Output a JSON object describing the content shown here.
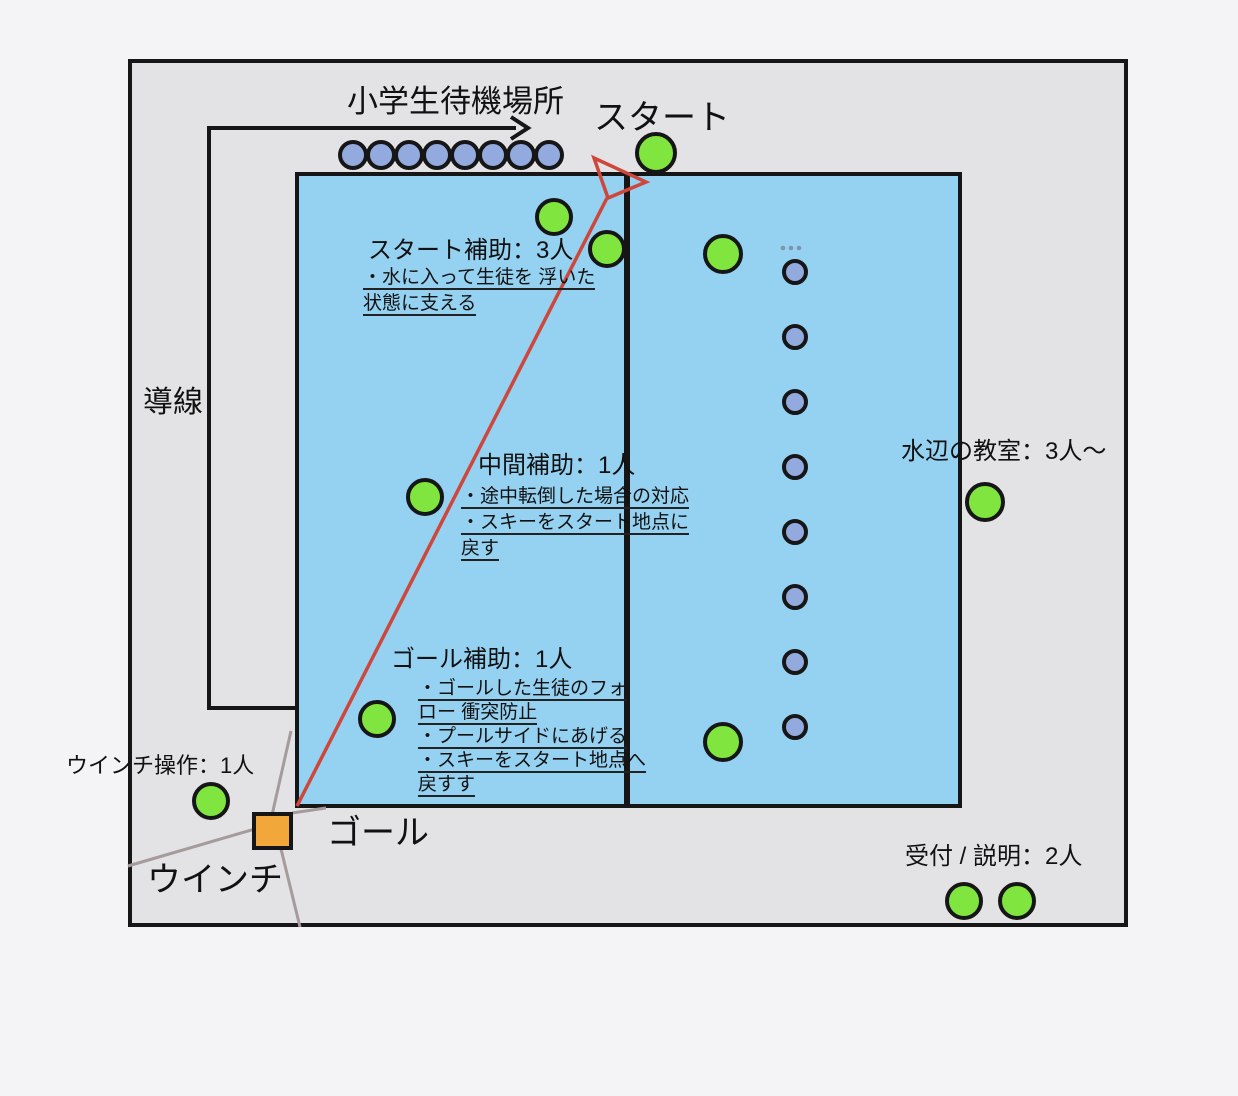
{
  "diagram": {
    "title_context": "プール水上スキー体験 配置図",
    "labels": {
      "waiting_area": "小学生待機場所",
      "start": "スタート",
      "guide_line": "導線",
      "goal": "ゴール",
      "winch": "ウインチ",
      "winch_operator": "ウインチ操作：1人",
      "classroom": "水辺の教室：3人〜",
      "reception": "受付 / 説明：2人"
    },
    "start_assist": {
      "title": "スタート補助：3人",
      "notes": [
        "・水に入って生徒を 浮いた",
        "状態に支える"
      ]
    },
    "middle_assist": {
      "title": "中間補助：1人",
      "notes": [
        "・途中転倒した場合の対応",
        "・スキーをスタート地点に",
        "戻す"
      ]
    },
    "goal_assist": {
      "title": "ゴール補助：1人",
      "notes": [
        "・ゴールした生徒のフォ",
        "ロー 衝突防止",
        "・プールサイドにあげる",
        "・スキーをスタート地点へ",
        "戻すす"
      ]
    },
    "counts": {
      "waiting_students": 8,
      "queue_students": 8,
      "staff_circles": 11
    },
    "colors": {
      "pool": "#95d1f1",
      "staff_circle": "#80e53e",
      "student_circle": "#92aade",
      "winch_box": "#f2a73a",
      "course_line": "#cf463a",
      "cable": "#a59b9b",
      "outline": "#161616"
    }
  }
}
